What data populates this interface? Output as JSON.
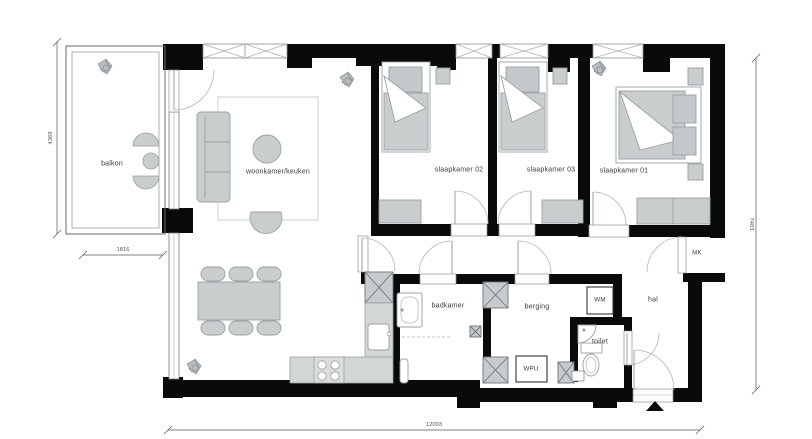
{
  "plan": {
    "labels": {
      "balkon": "balkon",
      "woonkamer": "woonkamer/keuken",
      "slaapkamer02": "slaapkamer 02",
      "slaapkamer03": "slaapkamer 03",
      "slaapkamer01": "slaapkamer 01",
      "badkamer": "badkamer",
      "berging": "berging",
      "toilet": "toilet",
      "hal": "hal",
      "mk": "MK",
      "wm": "WM",
      "wpu": "WPU"
    },
    "dimensions": {
      "left": "4369",
      "balcony": "1816",
      "right": "7483",
      "bottom": "12003"
    },
    "colors": {
      "wall": "#0a0a0a",
      "furniture": "#c9cdce",
      "furniture_stroke": "#9aa0a4",
      "thin_line": "#a9aeb1",
      "dimension_line": "#555555",
      "text": "#3a3a3a"
    }
  }
}
